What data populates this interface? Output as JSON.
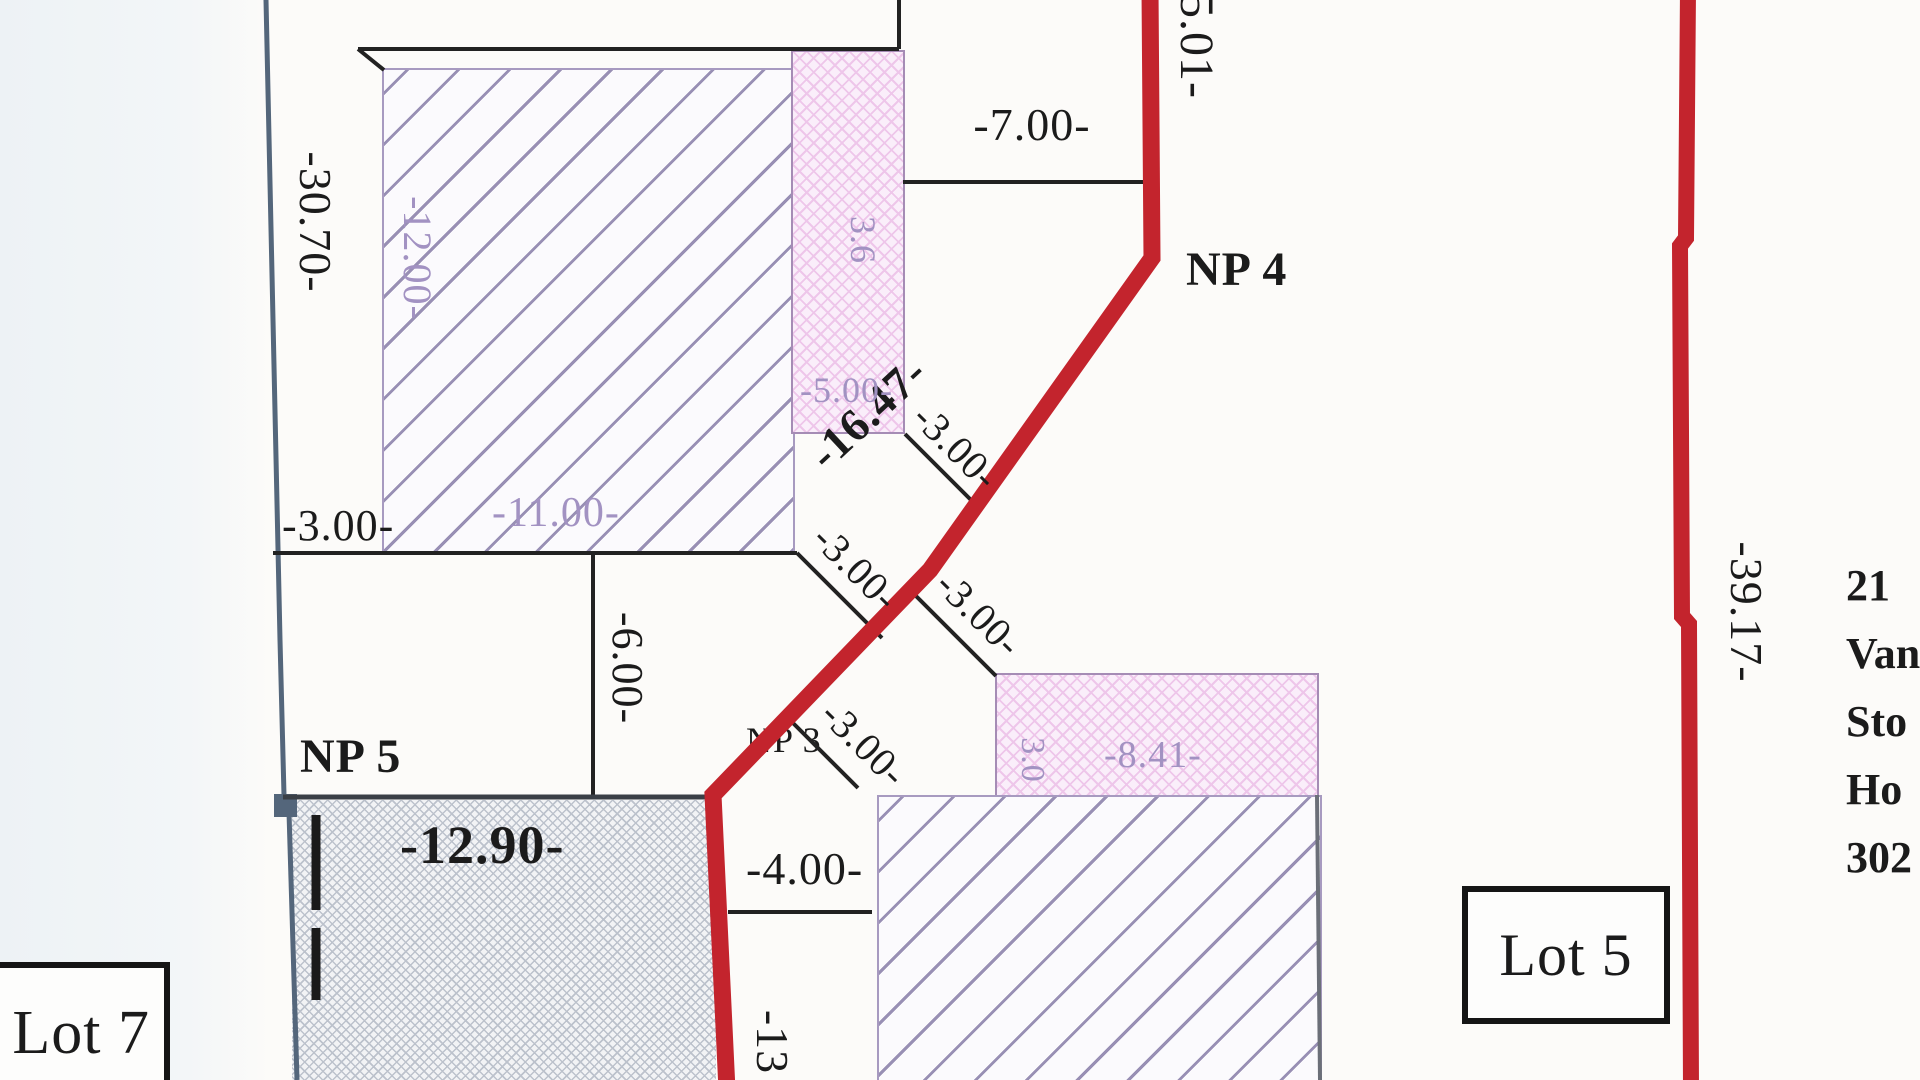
{
  "plan": {
    "labels": {
      "np4": "NP 4",
      "np5": "NP 5",
      "np3": "NP 3",
      "lot5": "Lot 5",
      "lot7": "Lot 7"
    },
    "dimensions": {
      "left_boundary": "-30.70-",
      "upper_right_boundary": "-5.01-",
      "top_width": "-7.00-",
      "red_diagonal": "-16.47-",
      "building1_height": "-12.00-",
      "building1_width": "-11.00-",
      "left_offset": "-3.00-",
      "offset_a": "-3.00-",
      "offset_b": "-3.00-",
      "offset_c": "-3.00-",
      "offset_d": "-3.00-",
      "mid_vertical": "-6.00-",
      "gray_width": "-12.90-",
      "lower_offset": "-4.00-",
      "bottom_vertical": "-13",
      "pink1_depth": "3.6",
      "pink1_width": "-5.00-",
      "pink2_depth": "3.0",
      "pink2_width": "-8.41-",
      "right_boundary": "-39.17-"
    },
    "side_text": [
      "21",
      "Van",
      "Sto",
      "Ho",
      "302"
    ],
    "colors": {
      "boundary_red": "#c3242d",
      "boundary_blue": "#54667b",
      "construction_purple": "#a79ac0",
      "dimension_purple": "#a292c2",
      "ink_black": "#1b1b1b"
    }
  }
}
